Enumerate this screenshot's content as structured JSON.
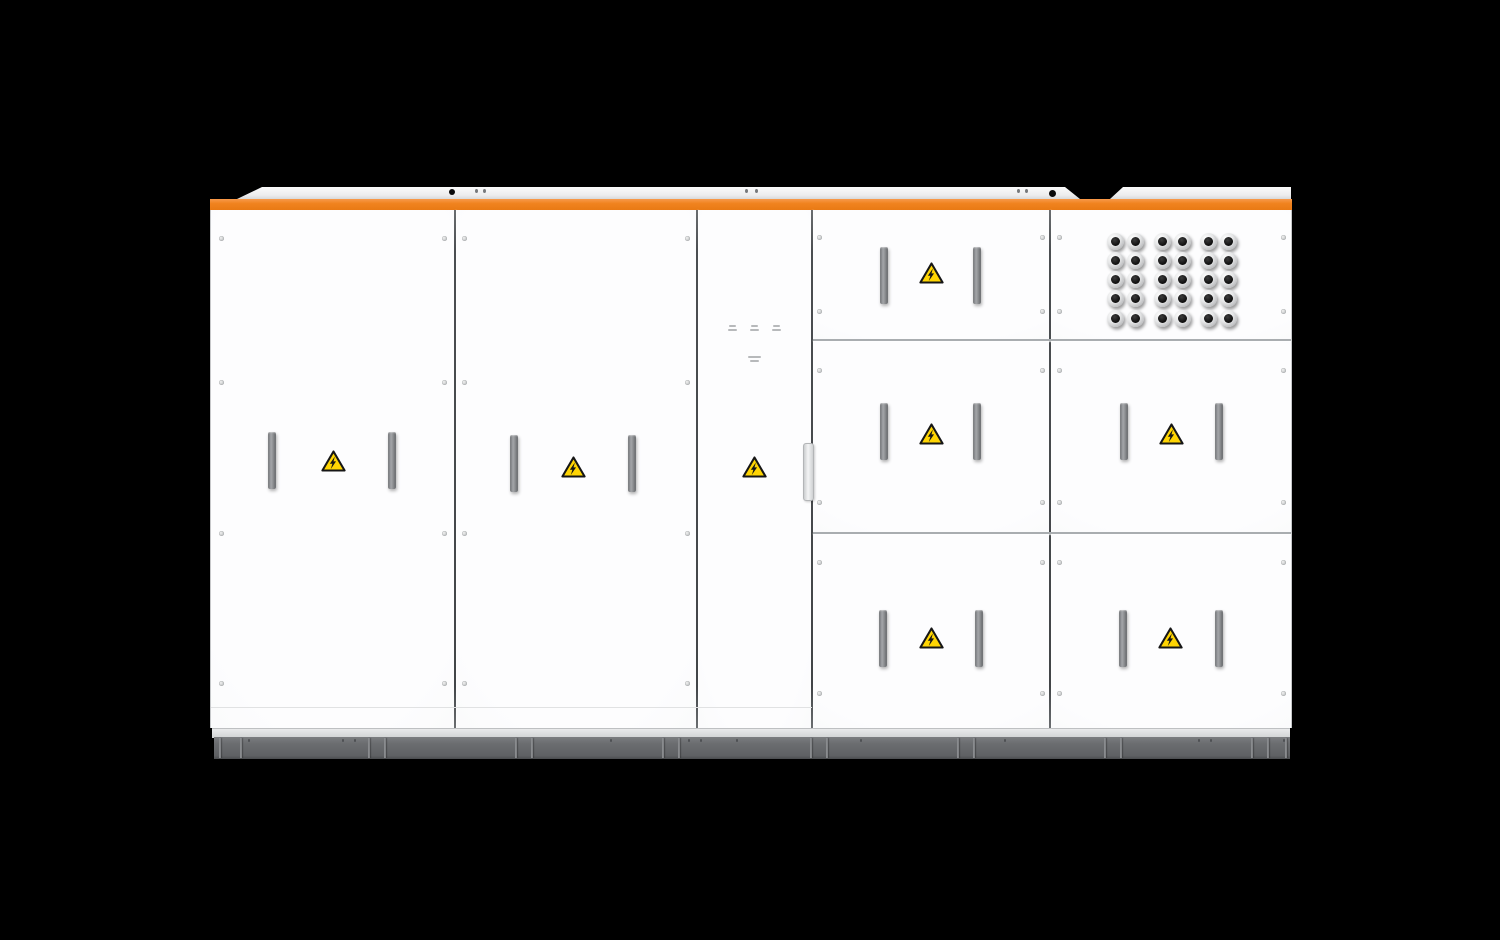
{
  "product": {
    "brand": "SUNGROW",
    "description": "Utility-scale energy storage / power conversion cabinet, front view render on black background",
    "warning_icon": "high-voltage-warning-icon",
    "warning_icon_count": 8,
    "cable_gland_count": 30,
    "door_count": 9
  },
  "colors": {
    "background": "#000000",
    "accent_orange": "#f0831f",
    "panel_white": "#fbfbfc",
    "roof_gray": "#f0f0f1",
    "base_gray": "#6b6d70",
    "handle_gray": "#8f9194",
    "warning_yellow": "#ffd503",
    "estop_red": "#d81f14",
    "indicator_green": "#3da44a",
    "indicator_red": "#e5332a",
    "indicator_white": "#f2f2f2",
    "brand_orange": "#f08121"
  },
  "control_panel": {
    "indicators": [
      {
        "name": "power-indicator-light",
        "color_key": "indicator_white"
      },
      {
        "name": "run-indicator-light",
        "color_key": "indicator_green"
      },
      {
        "name": "fault-indicator-light",
        "color_key": "indicator_red"
      }
    ],
    "emergency_stop": {
      "name": "emergency-stop-button"
    }
  },
  "layout": {
    "stage": {
      "w": 1500,
      "h": 940
    },
    "doors": [
      {
        "x": 211,
        "y": 210,
        "w": 244,
        "h": 518,
        "name": "door-1"
      },
      {
        "x": 456,
        "y": 210,
        "w": 240,
        "h": 518,
        "name": "door-2"
      },
      {
        "x": 698,
        "y": 210,
        "w": 113,
        "h": 518,
        "name": "door-control"
      },
      {
        "x": 813,
        "y": 210,
        "w": 236,
        "h": 130,
        "name": "bay-top-left"
      },
      {
        "x": 1051,
        "y": 210,
        "w": 240,
        "h": 130,
        "name": "bay-top-right"
      },
      {
        "x": 813,
        "y": 341,
        "w": 236,
        "h": 191,
        "name": "bay-mid-left"
      },
      {
        "x": 1051,
        "y": 341,
        "w": 240,
        "h": 191,
        "name": "bay-mid-right"
      },
      {
        "x": 813,
        "y": 534,
        "w": 236,
        "h": 194,
        "name": "bay-bottom-left"
      },
      {
        "x": 1051,
        "y": 534,
        "w": 240,
        "h": 194,
        "name": "bay-bottom-right"
      }
    ],
    "seams_v": [
      455,
      697,
      812,
      1050
    ],
    "seams_h": [
      {
        "y": 340,
        "x1": 813,
        "x2": 1291
      },
      {
        "y": 533,
        "x1": 813,
        "x2": 1291
      }
    ],
    "kick_seam": {
      "y": 707,
      "x1": 211,
      "x2": 812
    },
    "handle": {
      "w": 8,
      "h": 57
    },
    "handles": [
      [
        268,
        432
      ],
      [
        388,
        432
      ],
      [
        510,
        435
      ],
      [
        628,
        435
      ],
      [
        880,
        247
      ],
      [
        973,
        247
      ],
      [
        880,
        403
      ],
      [
        973,
        403
      ],
      [
        1120,
        403
      ],
      [
        1215,
        403
      ],
      [
        879,
        610
      ],
      [
        975,
        610
      ],
      [
        1119,
        610
      ],
      [
        1215,
        610
      ]
    ],
    "edge_handle": {
      "x": 803,
      "y": 443,
      "w": 9,
      "h": 56
    },
    "triangles": [
      [
        333,
        461
      ],
      [
        573,
        467
      ],
      [
        754,
        467
      ],
      [
        931,
        273
      ],
      [
        931,
        434
      ],
      [
        1171,
        434
      ],
      [
        931,
        638
      ],
      [
        1170,
        638
      ]
    ],
    "screws": [
      [
        221,
        238
      ],
      [
        444,
        238
      ],
      [
        221,
        382
      ],
      [
        444,
        382
      ],
      [
        221,
        533
      ],
      [
        444,
        533
      ],
      [
        221,
        683
      ],
      [
        444,
        683
      ],
      [
        464,
        238
      ],
      [
        687,
        238
      ],
      [
        464,
        382
      ],
      [
        687,
        382
      ],
      [
        464,
        533
      ],
      [
        687,
        533
      ],
      [
        464,
        683
      ],
      [
        687,
        683
      ],
      [
        819,
        237
      ],
      [
        1042,
        237
      ],
      [
        1059,
        237
      ],
      [
        1283,
        237
      ],
      [
        819,
        311
      ],
      [
        1042,
        311
      ],
      [
        1059,
        311
      ],
      [
        1283,
        311
      ],
      [
        819,
        370
      ],
      [
        1042,
        370
      ],
      [
        1059,
        370
      ],
      [
        1283,
        370
      ],
      [
        819,
        502
      ],
      [
        1042,
        502
      ],
      [
        1059,
        502
      ],
      [
        1283,
        502
      ],
      [
        819,
        562
      ],
      [
        1042,
        562
      ],
      [
        1059,
        562
      ],
      [
        1283,
        562
      ],
      [
        819,
        693
      ],
      [
        1042,
        693
      ],
      [
        1059,
        693
      ],
      [
        1283,
        693
      ]
    ],
    "glands": {
      "cols": [
        1115,
        1135,
        1162,
        1182,
        1208,
        1228
      ],
      "rows": [
        241,
        260,
        279,
        298,
        318
      ],
      "outer": 17
    },
    "microbars": [
      [
        732,
        325,
        7
      ],
      [
        732,
        329,
        9
      ],
      [
        754,
        325,
        7
      ],
      [
        754,
        329,
        9
      ],
      [
        776,
        325,
        7
      ],
      [
        776,
        329,
        9
      ],
      [
        754,
        356,
        13
      ],
      [
        754,
        360,
        9
      ]
    ],
    "roof_holes": [
      [
        452,
        192,
        6
      ],
      [
        1052,
        193,
        7
      ]
    ],
    "roof_marks": [
      [
        476,
        191
      ],
      [
        484,
        191
      ],
      [
        746,
        191
      ],
      [
        756,
        191
      ],
      [
        1018,
        191
      ],
      [
        1026,
        191
      ]
    ],
    "base": {
      "divider_pairs": [
        376,
        523,
        670,
        818,
        965,
        1112,
        1259
      ],
      "divider_singles": [
        219,
        240,
        1285
      ],
      "bolts": [
        [
          248,
          739
        ],
        [
          342,
          739
        ],
        [
          354,
          739
        ],
        [
          610,
          739
        ],
        [
          688,
          739
        ],
        [
          700,
          739
        ],
        [
          736,
          739
        ],
        [
          860,
          739
        ],
        [
          1004,
          739
        ],
        [
          1198,
          739
        ],
        [
          1210,
          739
        ],
        [
          1283,
          739
        ]
      ]
    }
  }
}
